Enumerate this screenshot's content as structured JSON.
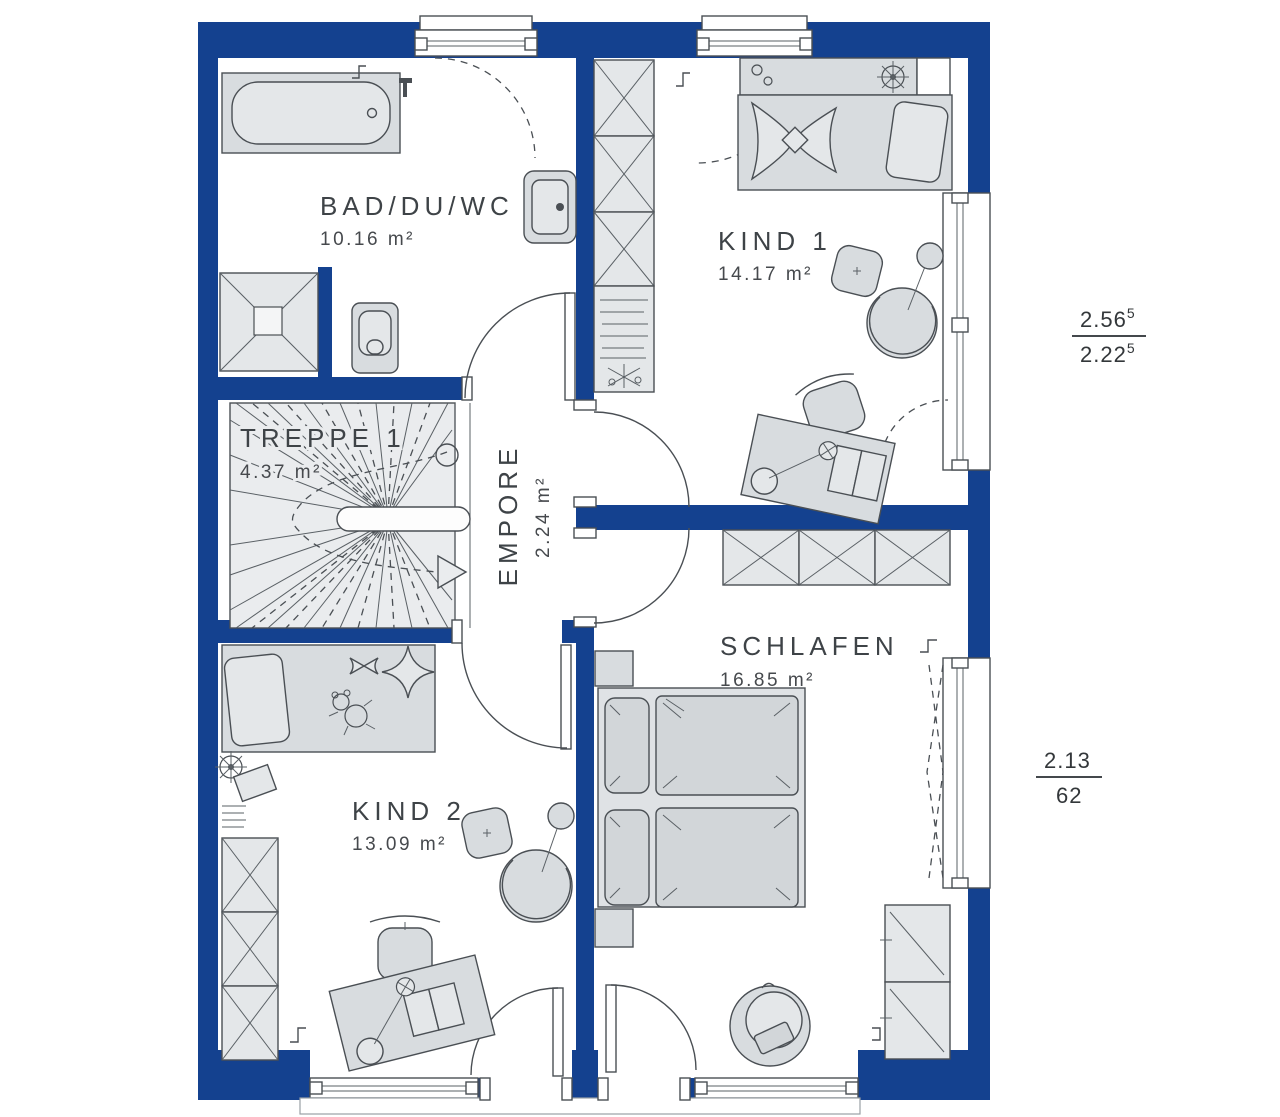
{
  "plan": {
    "type": "floor-plan",
    "language": "de"
  },
  "rooms": [
    {
      "id": "bad",
      "label": "BAD/DU/WC",
      "area": "10.16 m²"
    },
    {
      "id": "kind1",
      "label": "KIND 1",
      "area": "14.17 m²"
    },
    {
      "id": "treppe",
      "label": "TREPPE 1",
      "area": "4.37 m²"
    },
    {
      "id": "empore",
      "label": "EMPORE",
      "area": "2.24 m²"
    },
    {
      "id": "schlafen",
      "label": "SCHLAFEN",
      "area": "16.85 m²"
    },
    {
      "id": "kind2",
      "label": "KIND 2",
      "area": "13.09 m²"
    }
  ],
  "dimensions": {
    "upper": {
      "numerator": "2.56",
      "numerator_sup": "5",
      "denominator": "2.22",
      "denominator_sup": "5"
    },
    "lower": {
      "numerator": "2.13",
      "denominator": "62"
    }
  },
  "colors": {
    "wall": "#14418f",
    "furniture": "#d8dcdf",
    "furniture_light": "#e4e7e9",
    "outline": "#4a4f54",
    "text": "#3e4347",
    "background": "#ffffff"
  }
}
